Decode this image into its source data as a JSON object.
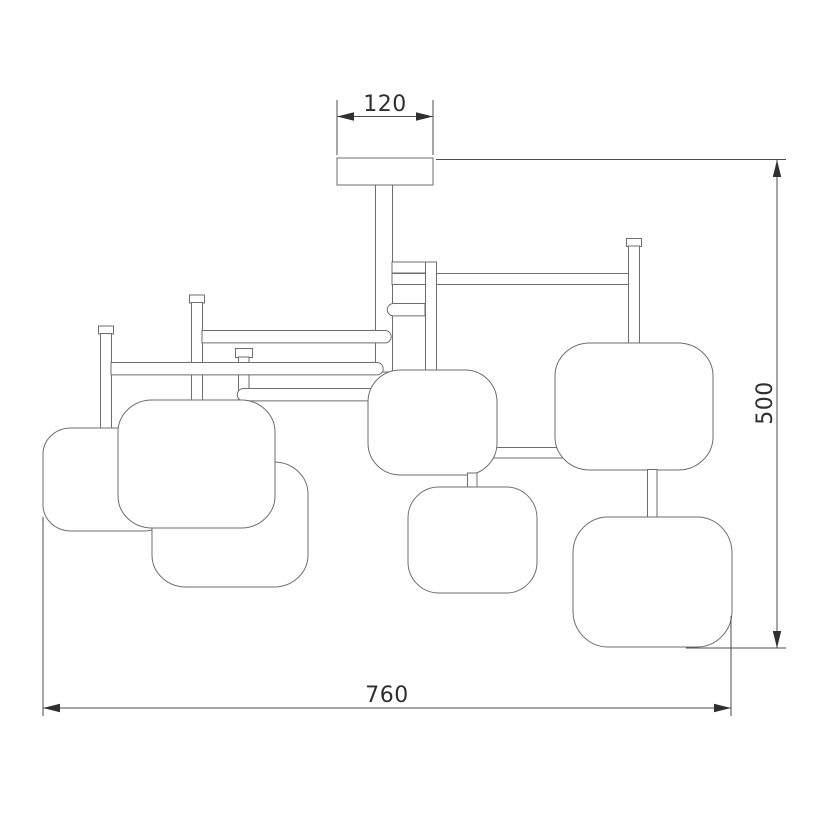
{
  "drawing": {
    "subject": "technical dimension drawing of a ceiling chandelier with seven rounded-square shades on horizontal arms",
    "shade_count": 7,
    "colors": {
      "background": "#ffffff",
      "outline": "#6e6e6e",
      "dimension_line": "#4c4c4c",
      "text": "#2f2f2f"
    },
    "dimensions": {
      "canopy_width": {
        "label": "120",
        "orientation": "horizontal",
        "position": "top"
      },
      "overall_height": {
        "label": "500",
        "orientation": "vertical",
        "position": "right"
      },
      "overall_width": {
        "label": "760",
        "orientation": "horizontal",
        "position": "bottom"
      }
    }
  }
}
